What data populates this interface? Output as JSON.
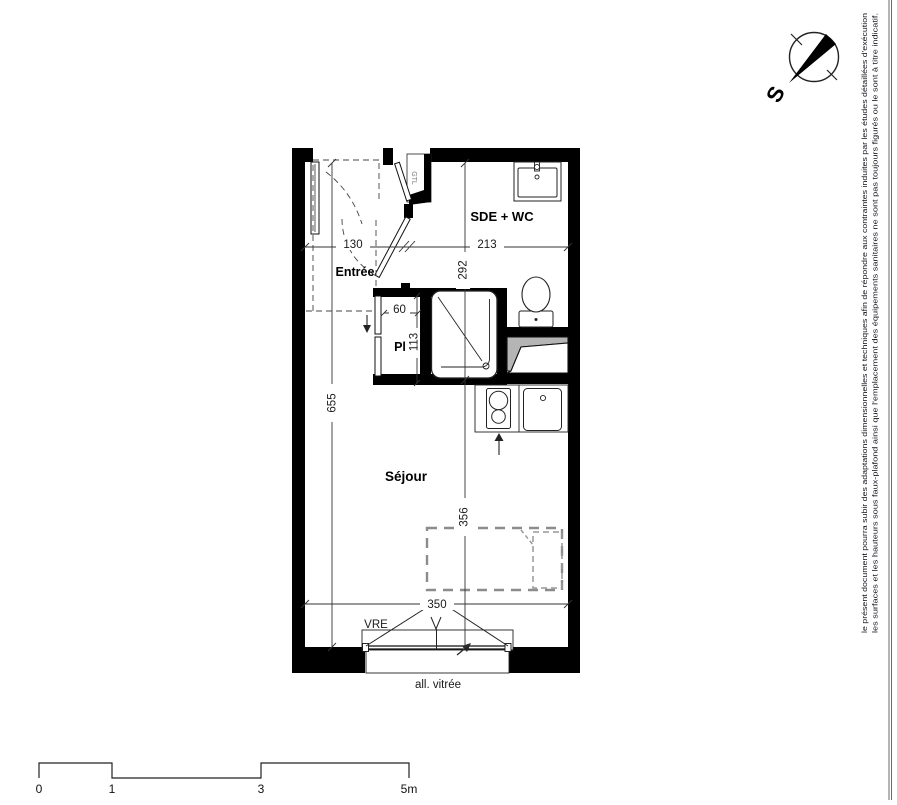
{
  "plan": {
    "room_labels": {
      "entree": "Entrée",
      "sde_wc": "SDE + WC",
      "closet": "Pl",
      "sejour": "Séjour",
      "gtl": "GTL"
    },
    "dims": {
      "entree_width": "130",
      "sde_width": "213",
      "sde_depth": "292",
      "closet_width": "60",
      "closet_depth": "113",
      "total_depth": "655",
      "sejour_depth": "356",
      "window_width": "350"
    },
    "window": {
      "type": "VRE",
      "sill": "all. vitrée"
    }
  },
  "compass": {
    "south": "S"
  },
  "scale_bar": {
    "ticks": [
      "0",
      "1",
      "3",
      "5m"
    ]
  },
  "disclaimer": {
    "line1": "le présent document pourra subir des adaptations dimensionnelles et techniques afin de répondre aux contraintes induites par les études détaillées d'exécution",
    "line2": "les surfaces et les hauteurs sous faux-plafond ainsi que l'emplacement des équipements sanitaires ne sont pas toujours figurés ou le sont à titre indicatif."
  },
  "colors": {
    "wall": "#000000",
    "duct_fill": "#b5b5b5",
    "bed_dash": "#8c8c8c"
  }
}
